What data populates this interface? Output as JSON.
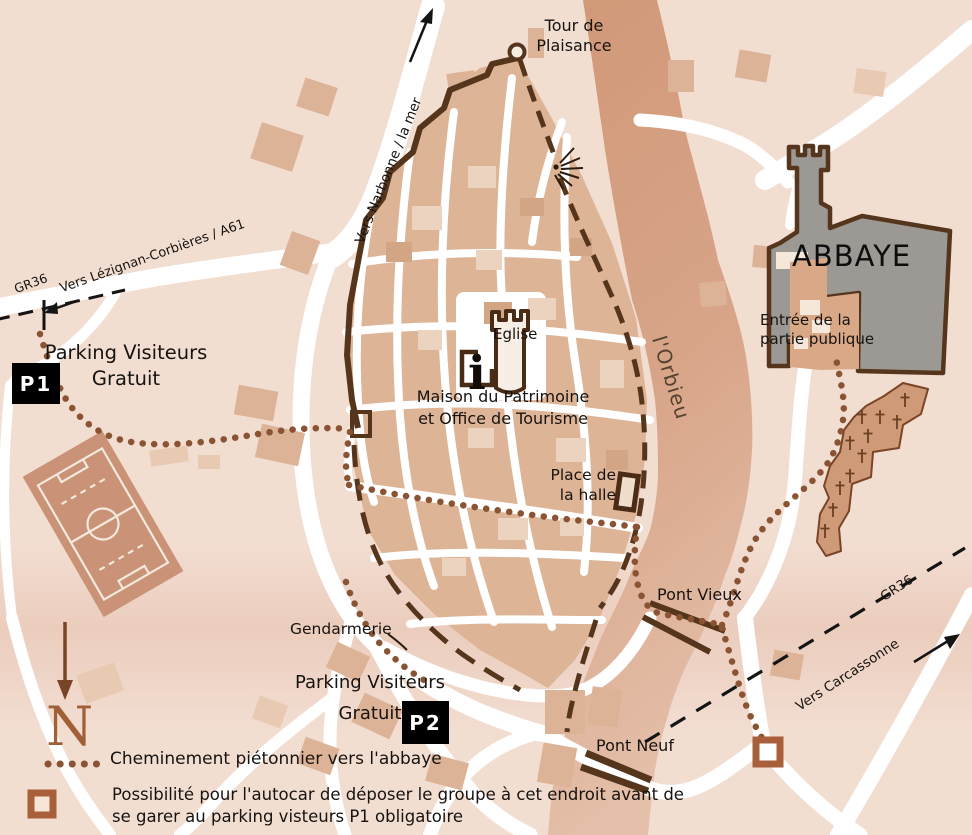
{
  "map": {
    "title": "Plan du village et de l'abbaye",
    "roads": {
      "narbonne": "Vers Narbonne / la mer",
      "lezignan": "Vers Lézignan-Corbières / A61",
      "carcassonne": "Vers Carcassonne",
      "gr36_left": "GR36",
      "gr36_right": "GR36"
    },
    "landmarks": {
      "tour": "Tour de\nPlaisance",
      "orbieu": "l'Orbieu",
      "eglise": "Eglise",
      "info_icon": "i",
      "maison": "Maison du Patrimoine\net Office de Tourisme",
      "halle": "Place de\nla halle",
      "abbaye": "ABBAYE",
      "entree": "Entrée de la\npartie publique",
      "pont_vieux": "Pont Vieux",
      "pont_neuf": "Pont Neuf",
      "gendarmerie": "Gendarmerie"
    },
    "parking": {
      "p1_label": "Parking Visiteurs\nGratuit",
      "p1_badge": "P1",
      "p2_label": "Parking Visiteurs\nGratuit",
      "p2_badge": "P2"
    },
    "legend": {
      "north": "N",
      "path_label": "Cheminement piétonnier vers l'abbaye",
      "dropoff_label": "Possibilité pour l'autocar de déposer le groupe à cet endroit avant de\nse garer au parking visteurs P1  obligatoire"
    },
    "colors": {
      "background": "#f2ddd1",
      "river": "#d6a284",
      "village_block": "#ddb496",
      "light_block": "#ebd3bf",
      "wall": "#56351d",
      "path_dots": "#8a5434",
      "abbey_gray": "#9c9994",
      "cemetery": "#cf9a77",
      "road": "#ffffff",
      "badge": "#000000",
      "marker": "#a8603a"
    }
  }
}
